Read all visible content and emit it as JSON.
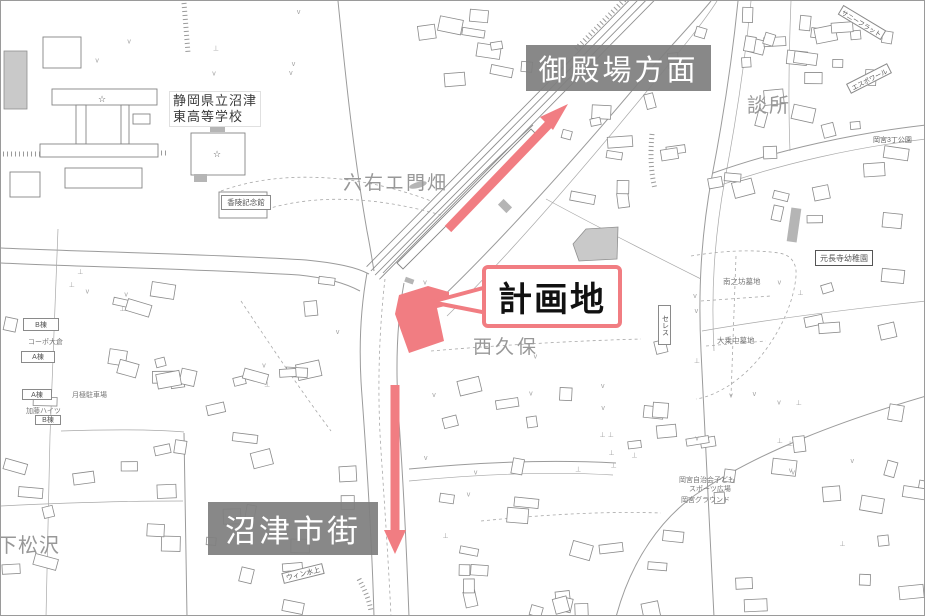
{
  "map": {
    "annotations": {
      "direction_gotemba": "御殿場方面",
      "direction_numazu": "沼津市街",
      "planned_site": "計画地"
    },
    "region_labels": {
      "school_line1": "静岡県立沼津",
      "school_line2": "東高等学校",
      "rokuemonbata": "六右エ門畑",
      "nishikubo": "西久保",
      "danjo": "談所",
      "shimomatsuzawa": "下松沢"
    },
    "minor_labels": {
      "koryo_kinenkan": "香陵記念館",
      "espoir": "エスポワール",
      "sunny_flat": "サニーフラット",
      "okanomiya_park": "岡宮3丁公園",
      "genchoji_kindergarten": "元長寺幼稚園",
      "minaminobo_cemetery": "南之坊墓地",
      "daijo_cemetery": "大乗中墓地",
      "ceres": "セレス",
      "sports_plaza_line1": "岡宮自治会子ども",
      "sports_plaza_line2": "スポーツ広場",
      "okanomiya_ground": "岡宮グラウンド",
      "corpo_okura": "コーポ大倉",
      "b_wing_1": "B棟",
      "a_wing_1": "A棟",
      "a_wing_2": "A棟",
      "kato_heights": "加藤ハイツ",
      "b_wing_2": "B棟",
      "monthly_parking": "月極駐車場",
      "win_mizukami": "ウィン水上",
      "school_symbol": "☆"
    },
    "colors": {
      "highlight_pink": "#f17d82",
      "direction_box_gray": "#7f7f7f",
      "map_line_gray": "#8a8a8a"
    }
  }
}
